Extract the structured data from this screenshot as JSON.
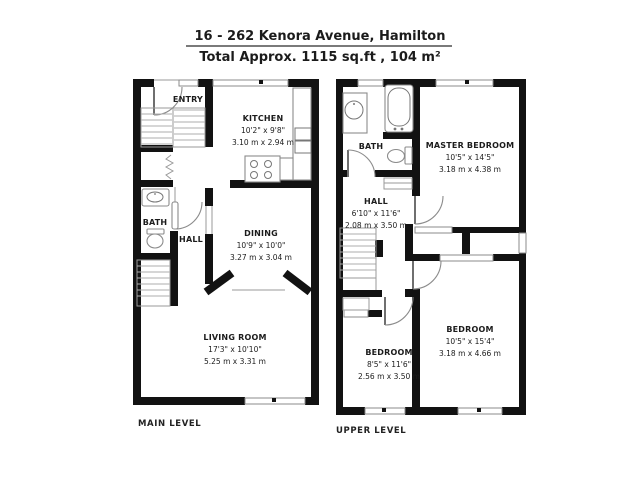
{
  "header": {
    "address": "16 - 262 Kenora Avenue, Hamilton",
    "total_area": "Total Approx. 1115 sq.ft , 104 m²"
  },
  "colors": {
    "wall": "#121212",
    "fixture_line": "#8b8b8b",
    "text": "#1c1c1c",
    "background": "#ffffff"
  },
  "main_level": {
    "label": "MAIN LEVEL",
    "rooms": {
      "entry": {
        "name": "ENTRY"
      },
      "kitchen": {
        "name": "KITCHEN",
        "imperial": "10'2\" x 9'8\"",
        "metric": "3.10 m x 2.94 m"
      },
      "bath": {
        "name": "BATH"
      },
      "hall": {
        "name": "HALL"
      },
      "dining": {
        "name": "DINING",
        "imperial": "10'9\" x 10'0\"",
        "metric": "3.27 m x 3.04 m"
      },
      "living": {
        "name": "LIVING ROOM",
        "imperial": "17'3\" x 10'10\"",
        "metric": "5.25 m x 3.31 m"
      }
    }
  },
  "upper_level": {
    "label": "UPPER LEVEL",
    "rooms": {
      "bath": {
        "name": "BATH"
      },
      "hall": {
        "name": "HALL",
        "imperial": "6'10\" x 11'6\"",
        "metric": "2.08 m x 3.50 m"
      },
      "master": {
        "name": "MASTER BEDROOM",
        "imperial": "10'5\" x 14'5\"",
        "metric": "3.18 m x 4.38 m"
      },
      "bedroom2": {
        "name": "BEDROOM",
        "imperial": "8'5\" x 11'6\"",
        "metric": "2.56 m x 3.50 m"
      },
      "bedroom3": {
        "name": "BEDROOM",
        "imperial": "10'5\" x 15'4\"",
        "metric": "3.18 m x 4.66 m"
      }
    }
  }
}
